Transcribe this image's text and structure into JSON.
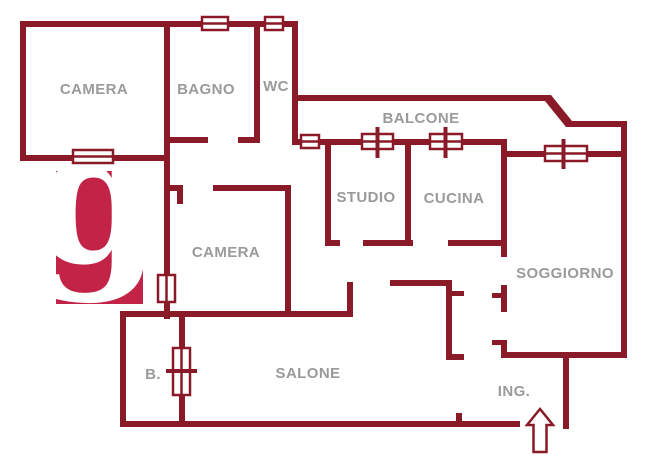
{
  "colors": {
    "wall": "#8a1a28",
    "label": "#9a9a9a",
    "logo_bg": "#c22347",
    "logo_fg": "#ffffff",
    "background": "#ffffff"
  },
  "logo": {
    "letter": "g"
  },
  "rooms": {
    "camera1": {
      "label": "CAMERA"
    },
    "bagno": {
      "label": "BAGNO"
    },
    "wc": {
      "label": "WC"
    },
    "balcone": {
      "label": "BALCONE"
    },
    "studio": {
      "label": "STUDIO"
    },
    "cucina": {
      "label": "CUCINA"
    },
    "camera2": {
      "label": "CAMERA"
    },
    "soggiorno": {
      "label": "SOGGIORNO"
    },
    "salone": {
      "label": "SALONE"
    },
    "bagno2": {
      "label": "B."
    },
    "ingresso": {
      "label": "ING."
    }
  },
  "icons": {
    "windows": "window-icon",
    "doors": "door-icon",
    "entrance": "up-arrow"
  }
}
